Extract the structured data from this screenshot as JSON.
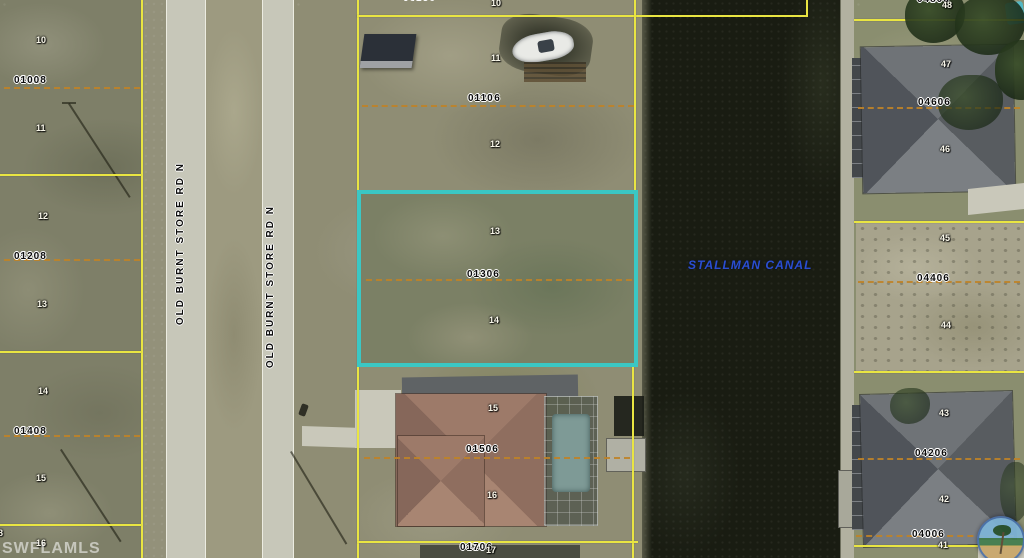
{
  "map": {
    "watermark": "SWFLAMLS",
    "canal": {
      "label": "STALLMAN CANAL",
      "text_color": "#2a4ed2"
    },
    "road": {
      "label": "OLD BURNT STORE RD N"
    },
    "highlight": {
      "parcel": "04256 0130",
      "color": "#3bc7c4"
    },
    "line_colors": {
      "parcel_boundary": "#e9e542",
      "lot_split_dashed": "#bf8328"
    },
    "parcels": [
      {
        "id": "05228-0100",
        "line1": "05228",
        "line2": "0100"
      },
      {
        "id": "05228-0120",
        "line1": "05228",
        "line2": "0120"
      },
      {
        "id": "05228-0140",
        "line1": "05228",
        "line2": "0140"
      },
      {
        "id": "04256-0090",
        "line1": "04256",
        "line2": "0090"
      },
      {
        "id": "04256-0110",
        "line1": "04256",
        "line2": "0110"
      },
      {
        "id": "04256-0130",
        "line1": "04256",
        "line2": "0130"
      },
      {
        "id": "04256-0150",
        "line1": "04256",
        "line2": "0150"
      },
      {
        "id": "04256-0170",
        "line1": "04256",
        "line2": "0170"
      },
      {
        "id": "04256-0480",
        "line1": "04256",
        "line2": "0480"
      },
      {
        "id": "04256-0460",
        "line1": "04256",
        "line2": "0460"
      },
      {
        "id": "04256-0440",
        "line1": "04256",
        "line2": "0440"
      },
      {
        "id": "04256-0420",
        "line1": "04256",
        "line2": "0420"
      },
      {
        "id": "04256-0400",
        "line1": "04256",
        "line2": "0400"
      }
    ],
    "lots": [
      "10",
      "11",
      "12",
      "13",
      "14",
      "15",
      "16",
      "10",
      "11",
      "12",
      "13",
      "14",
      "15",
      "16",
      "17",
      "48",
      "47",
      "46",
      "45",
      "44",
      "43",
      "42",
      "41",
      "8"
    ]
  }
}
